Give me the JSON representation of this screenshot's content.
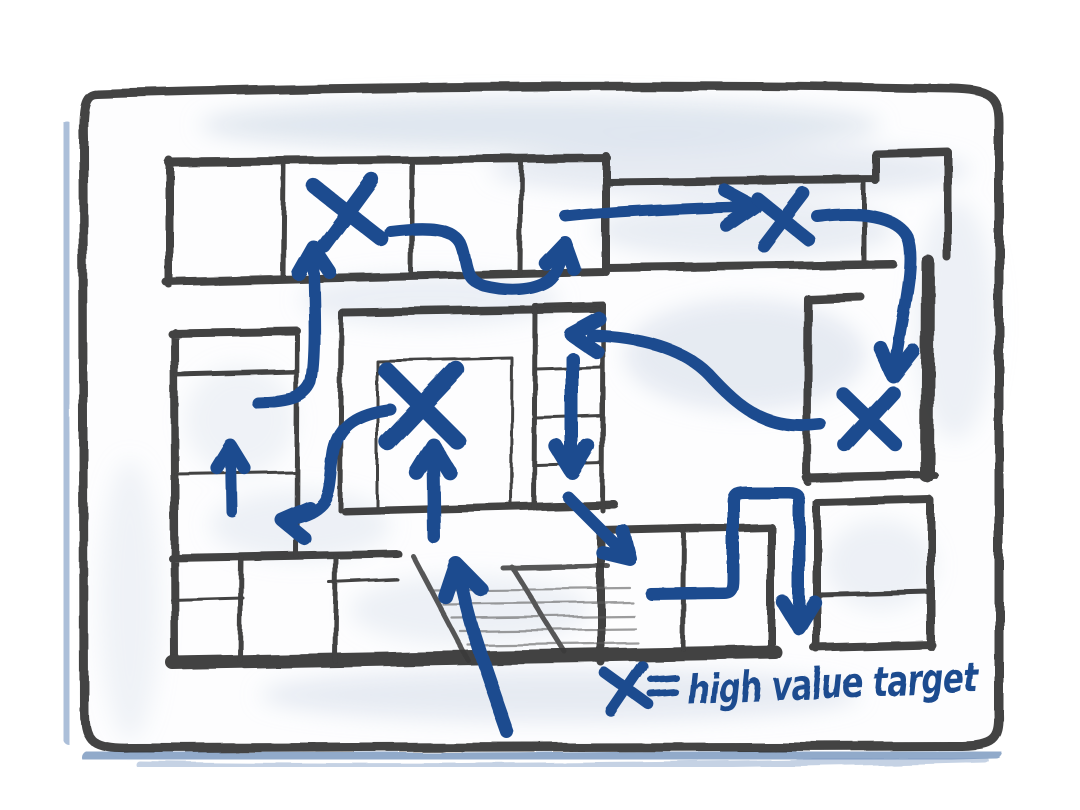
{
  "title": "hand-drawn building floor plan with infiltration route sketch",
  "colors": {
    "ink": "#1f4c8f",
    "wall": "#2d2d2d",
    "stairs_edge": "#3a3a3a",
    "tread": "#5a5a5a",
    "chalk": "#5b80b4",
    "wash": "#c9d5e4",
    "paper": "#fdfdfe"
  },
  "legend": {
    "symbol": "x",
    "separator": "=",
    "label": "high value target",
    "x": 627,
    "y": 689,
    "s": 21,
    "w": 11
  },
  "targets": [
    {
      "id": "x-topleft",
      "x": 348,
      "y": 213,
      "s": 31,
      "w": 15,
      "rot": -4
    },
    {
      "id": "x-central",
      "x": 422,
      "y": 406,
      "s": 38,
      "w": 17,
      "rot": 3
    },
    {
      "id": "x-hallway",
      "x": 783,
      "y": 219,
      "s": 25,
      "w": 13,
      "rot": -3
    },
    {
      "id": "x-right",
      "x": 869,
      "y": 419,
      "s": 27,
      "w": 14,
      "rot": 2
    }
  ],
  "arrows": [
    {
      "id": "corridor-to-topleft-x",
      "d": "M258,403 C292,402 305,397 311,383 C317,358 314,296 313,254",
      "hx": 313,
      "hy": 247,
      "ha": -92,
      "w": 12,
      "hl": 30
    },
    {
      "id": "weave-through-top-rooms",
      "d": "M390,231 C428,226 452,228 460,243 C468,260 462,279 484,286 C508,292 533,291 548,281 C557,274 561,262 563,250",
      "hx": 565,
      "hy": 243,
      "ha": -78,
      "w": 12,
      "hl": 28
    },
    {
      "id": "hallway-east",
      "d": "M566,217 C620,211 700,208 742,207",
      "hx": 754,
      "hy": 206,
      "ha": -3,
      "w": 11,
      "hl": 34
    },
    {
      "id": "topright-descend",
      "d": "M817,216 C858,211 897,215 907,237 C915,258 905,302 900,332 C897,352 895,362 894,368",
      "hx": 893,
      "hy": 376,
      "ha": 97,
      "w": 12,
      "hl": 32
    },
    {
      "id": "rightx-to-corridor",
      "d": "M821,425 C772,431 746,414 713,379 C691,353 652,337 592,335",
      "hx": 571,
      "hy": 334,
      "ha": 183,
      "w": 12,
      "hl": 32
    },
    {
      "id": "corridor-down",
      "d": "M572,358 L572,462",
      "hx": 572,
      "hy": 472,
      "ha": 90,
      "w": 13,
      "hl": 30
    },
    {
      "id": "central-x-approach",
      "d": "M434,537 L433,454",
      "hx": 433,
      "hy": 445,
      "ha": -90,
      "w": 13,
      "hl": 32
    },
    {
      "id": "center-to-left-rooms",
      "d": "M390,409 C358,413 338,424 333,452 C329,477 331,492 322,503 C313,513 299,517 290,518",
      "hx": 281,
      "hy": 519,
      "ha": 188,
      "w": 12,
      "hl": 30
    },
    {
      "id": "left-room-up",
      "d": "M232,512 L231,454",
      "hx": 231,
      "hy": 446,
      "ha": -90,
      "w": 11,
      "hl": 26
    },
    {
      "id": "corridor-diagonal-down",
      "d": "M568,497 L622,551",
      "hx": 630,
      "hy": 559,
      "ha": 45,
      "w": 12,
      "hl": 28
    },
    {
      "id": "zigzag-exit-down",
      "d": "M651,594 L724,593 C732,593 733,588 733,579 L733,502 C733,494 736,492 745,492 L788,492 C797,492 799,495 799,503 L799,620",
      "hx": 799,
      "hy": 628,
      "ha": 90,
      "w": 12,
      "hl": 30
    },
    {
      "id": "bottom-entry-up",
      "d": "M508,733 C496,699 482,660 473,630 C466,607 462,588 459,574",
      "hx": 456,
      "hy": 564,
      "ha": -103,
      "w": 13,
      "hl": 34
    }
  ]
}
